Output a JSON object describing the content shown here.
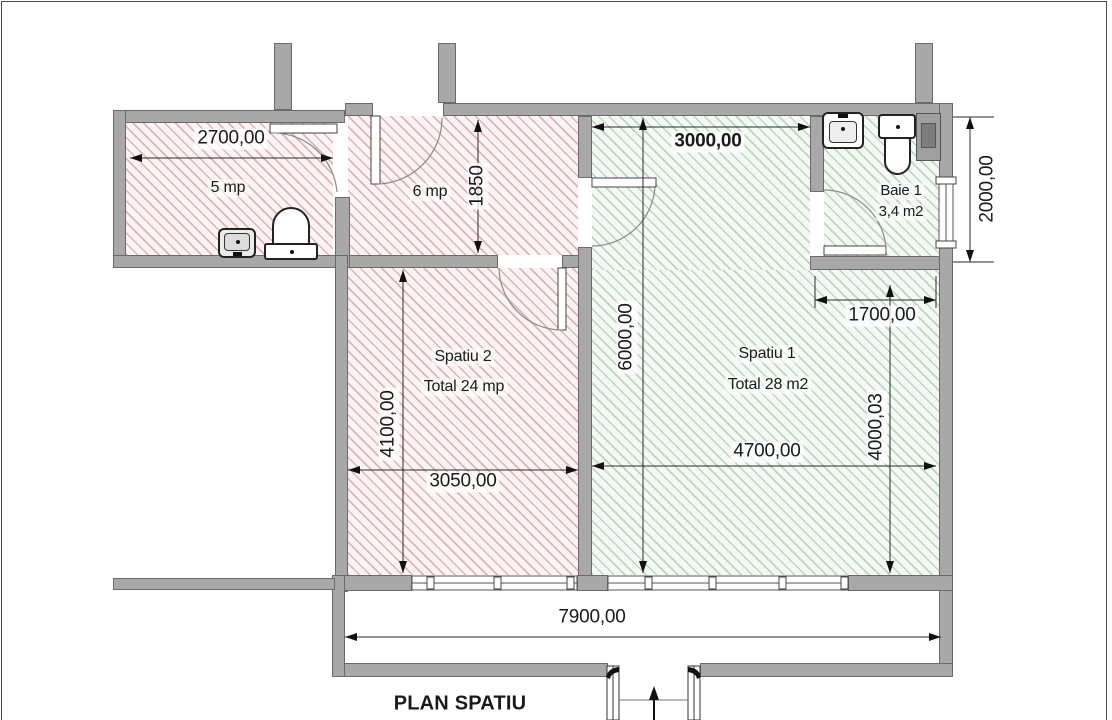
{
  "title": "PLAN SPATIU",
  "rooms": {
    "room5": {
      "area": "5 mp"
    },
    "room6": {
      "area": "6 mp"
    },
    "spatiu2": {
      "name": "Spatiu 2",
      "total": "Total 24 mp"
    },
    "spatiu1": {
      "name": "Spatiu 1",
      "total": "Total 28 m2"
    },
    "baie1": {
      "name": "Baie 1",
      "area": "3,4 m2"
    }
  },
  "dimensions": {
    "d2700": "2700,00",
    "d1850": "1850",
    "d3000": "3000,00",
    "d6000": "6000,00",
    "d2000": "2000,00",
    "d1700": "1700,00",
    "d4000": "4000,03",
    "d4700": "4700,00",
    "d4100": "4100,00",
    "d3050": "3050,00",
    "d7900": "7900,00"
  },
  "colors": {
    "wall": "#a8a8a8",
    "wall_outline": "#6a6a6a",
    "hatch_pink_line": "#c48082",
    "hatch_green_line": "#86af89",
    "dim_line": "#2a2a2a",
    "text": "#1a1a1a"
  }
}
